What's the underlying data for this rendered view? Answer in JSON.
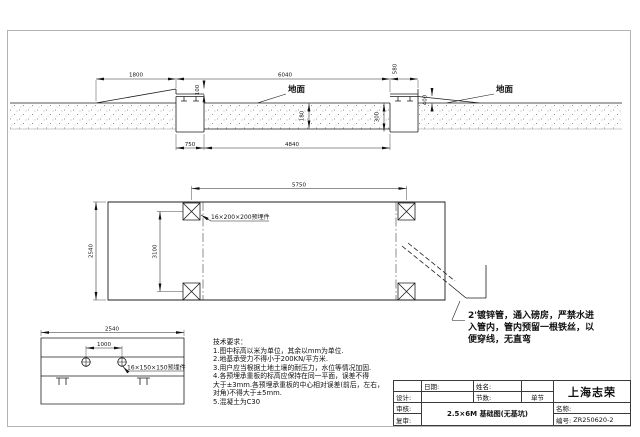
{
  "colors": {
    "line": "#1c1c1c",
    "frame": "#b3b3b3",
    "background": "#ffffff"
  },
  "section": {
    "ground_label": "地面",
    "d1800": "1800",
    "d6040": "6040",
    "d580": "580",
    "d100": "100",
    "d400": "400",
    "d300": "300",
    "d180": "180",
    "d750": "750",
    "d4840": "4840"
  },
  "plan": {
    "d5750": "5750",
    "d2540": "2540",
    "d3100": "3100",
    "plate_label": "16×200×200预埋件"
  },
  "detail": {
    "d2540": "2540",
    "d1000": "1000",
    "plate_label": "16×150×150预埋件"
  },
  "pipe_note": {
    "lines": [
      "2'镀锌管，通入磅房，严禁水进",
      "入管内，管内预留一根铁丝，以",
      "便穿线，无直弯"
    ]
  },
  "tech_notes": {
    "title": "技术要求：",
    "lines": [
      "1.图中标高以米为单位，其余以mm为单位.",
      "2.地基承受力不得小于200KN/平方米.",
      "3.用户应当根据土地土壤的耐压力，水位等情况加固.",
      "4.各预埋承重板的标高应保持在同一平面，误差不得",
      "大于±3mm.各预埋承重板的中心相对误差(前后，左右，",
      "对角)不得大于±5mm.",
      "5.混凝土为C30"
    ]
  },
  "title_block": {
    "date_label": "日期:",
    "name_label": "姓名:",
    "design_label": "设计:",
    "sections_label": "节数:",
    "sections_value": "单节",
    "check_label": "审核:",
    "recheck_label": "复审:",
    "company": "上海志荣",
    "drawing_title": "2.5×6M 基础图(无基坑)",
    "name_field_label": "名称:",
    "number_label": "编号:",
    "number_value": "ZR250620-2"
  }
}
